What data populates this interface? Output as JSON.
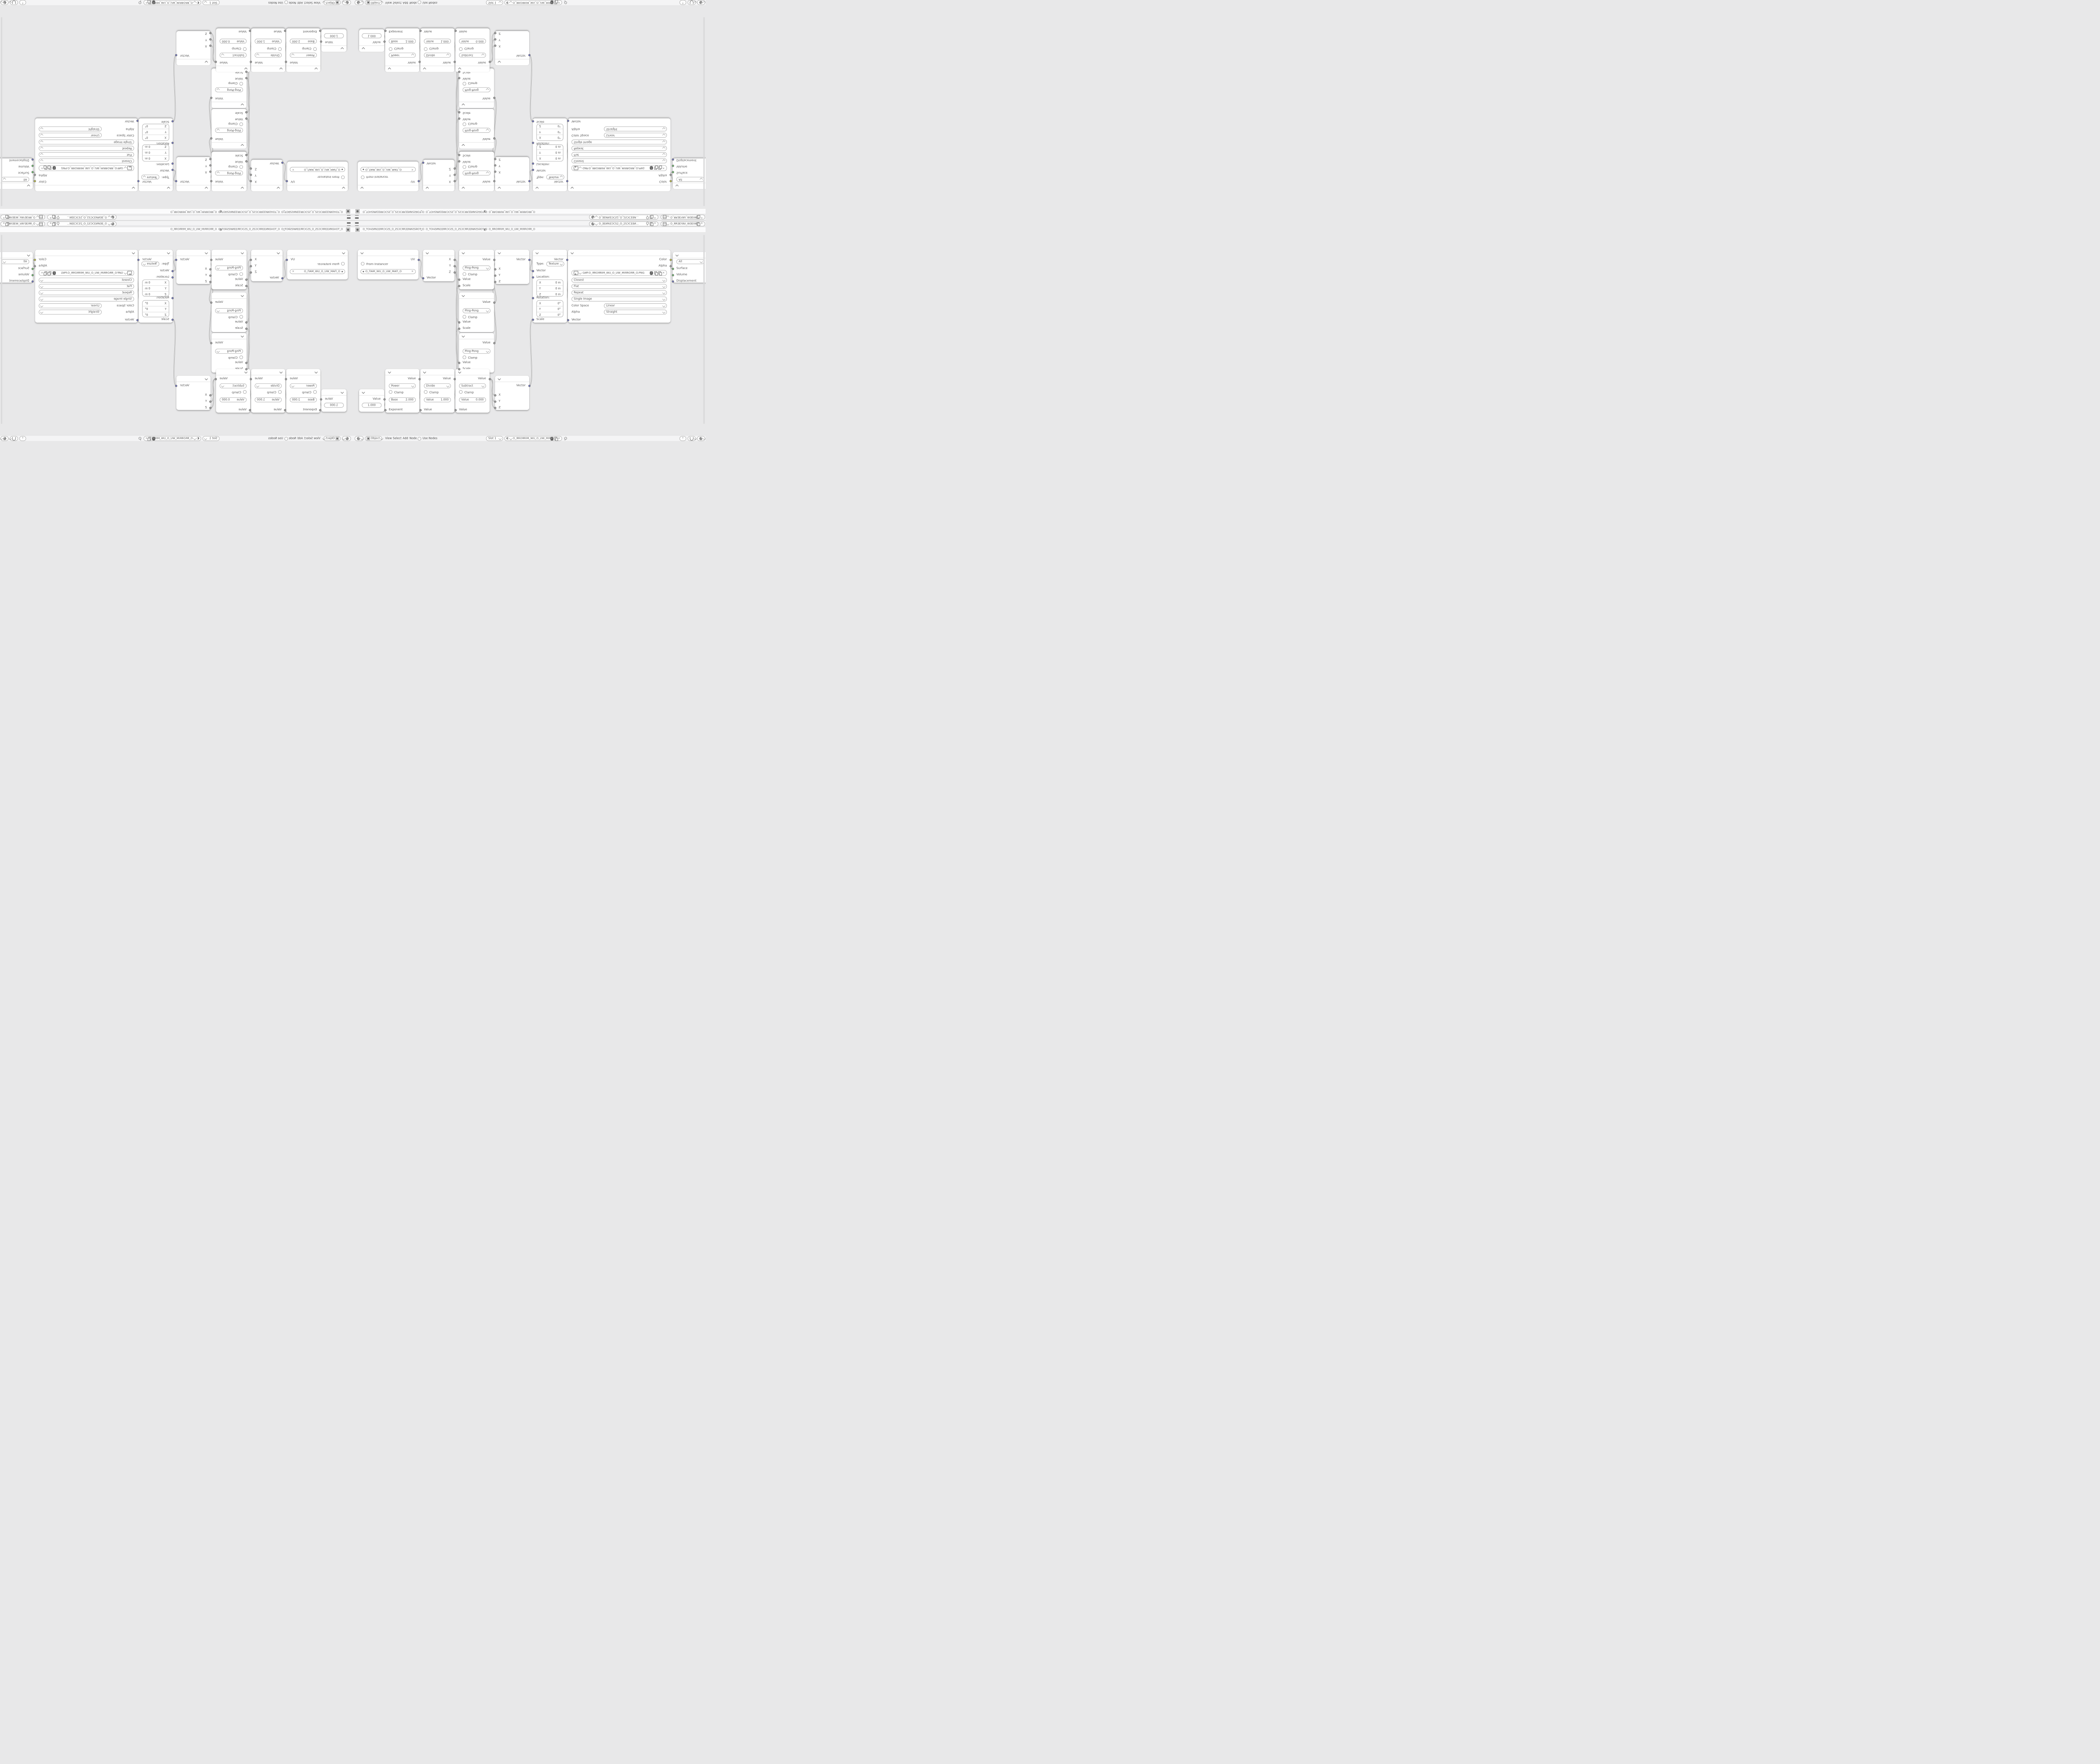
{
  "colors": {
    "canvas": "#e8e8e9",
    "bar_background": "#f4f4f5",
    "node_background": "#ffffff",
    "wire": "#9f9f9f",
    "socket_vector": "#6f74c9",
    "socket_value": "#a5a5a5",
    "socket_color": "#c6c633",
    "socket_shader": "#67c267"
  },
  "topbar": {
    "scene_name": "O_ƎEИNƎƆCS2_O_2SƆCƎƎИ…",
    "view_layer_name": "O_ЯRƎEYAV_WƎEIW_O_WIƎEW_VAYƎERЯ_O"
  },
  "breadcrumb": {
    "object_name": "O_TOHƧИNƎƎЯRƆCƧS_O_ƧSƆCЯRƎƎNИƧSHOT_O",
    "mesh_name": "O_TOHƧИNƎƎЯRƆCƧS_O_ƧSƆCЯRƎƎNИƧSHOT_O",
    "material_name": "O_ЯROЯRIM_WU_O_UW_MIЯROЯR_O",
    "separator": "〉"
  },
  "header": {
    "shader_type": "Object",
    "menu_view": "View",
    "menu_select": "Select",
    "menu_add": "Add",
    "menu_node": "Node",
    "use_nodes": "Use Nodes",
    "slot": "Slot 1",
    "material_name": "O_ЯROЯRIM_WU_O_UW_MIЯROЯR_O"
  },
  "nodes": {
    "uv_map": {
      "output": "UV",
      "from_instancer": "From Instancer",
      "uv_map_name": "O_ПAM_WU_O_UW_MAП_O"
    },
    "separate_xyz": {
      "out_x": "X",
      "out_y": "Y",
      "out_z": "Z",
      "input": "Vector"
    },
    "ping_pong": {
      "output": "Value",
      "operation": "Ping-Pong",
      "clamp": "Clamp",
      "in_value": "Value",
      "in_scale": "Scale"
    },
    "combine_xyz": {
      "output": "Vector",
      "in_x": "X",
      "in_y": "Y",
      "in_z": "Z"
    },
    "mapping": {
      "output": "Vector",
      "type_label": "Type:",
      "type_value": "Texture",
      "in_vector": "Vector",
      "location_label": "Location:",
      "rotation_label": "Rotation:",
      "scale_label": "Scale",
      "location": [
        {
          "axis": "X",
          "value": "0 m"
        },
        {
          "axis": "Y",
          "value": "0 m"
        },
        {
          "axis": "Z",
          "value": "0 m"
        }
      ],
      "rotation": [
        {
          "axis": "X",
          "value": "0°"
        },
        {
          "axis": "Y",
          "value": "0°"
        },
        {
          "axis": "Z",
          "value": "0°"
        }
      ]
    },
    "image_texture": {
      "out_color": "Color",
      "out_alpha": "Alpha",
      "filename": "GИP.O_ЯROЯRIM_WU_O_UW_MIЯROЯR_O.PNG",
      "interpolation": "Closest",
      "projection": "Flat",
      "extension": "Repeat",
      "source": "Single Image",
      "color_space_label": "Color Space",
      "color_space_value": "Linear",
      "alpha_label": "Alpha",
      "alpha_value": "Straight",
      "in_vector": "Vector"
    },
    "material_output": {
      "target": "All",
      "in_surface": "Surface",
      "in_volume": "Volume",
      "in_displacement": "Displacement"
    },
    "value_node": {
      "output": "Value",
      "value": "1.000"
    },
    "math_power": {
      "output": "Value",
      "operation": "Power",
      "clamp": "Clamp",
      "field_label": "Base",
      "field_value": "2.000",
      "input": "Exponent"
    },
    "math_divide": {
      "output": "Value",
      "operation": "Divide",
      "clamp": "Clamp",
      "field_label": "Value",
      "field_value": "1.000",
      "input": "Value"
    },
    "math_subtract": {
      "output": "Value",
      "operation": "Subtract",
      "clamp": "Clamp",
      "field_label": "Value",
      "field_value": "0.000",
      "input": "Value"
    }
  },
  "links": [
    [
      "uv.out",
      "sep.in"
    ],
    [
      "sep.x",
      "pp1.val"
    ],
    [
      "sep.y",
      "pp2.val"
    ],
    [
      "sep.z",
      "pp3.val"
    ],
    [
      "pp1.out",
      "c1.x"
    ],
    [
      "pp2.out",
      "c1.y"
    ],
    [
      "pp3.out",
      "c1.z"
    ],
    [
      "c1.out",
      "map.vec"
    ],
    [
      "map.out",
      "img.vec"
    ],
    [
      "img.color",
      "mo.surface"
    ],
    [
      "val.out",
      "pw.in"
    ],
    [
      "pw.out",
      "dv.in"
    ],
    [
      "dv.out",
      "sb.in"
    ],
    [
      "sb.out",
      "c2.x"
    ],
    [
      "sb.out",
      "c2.y"
    ],
    [
      "sb.out",
      "c2.z"
    ],
    [
      "c2.out",
      "map.scale"
    ],
    [
      "dv.out",
      "pp1.scale"
    ],
    [
      "dv.out",
      "pp2.scale"
    ],
    [
      "dv.out",
      "pp3.scale"
    ]
  ]
}
